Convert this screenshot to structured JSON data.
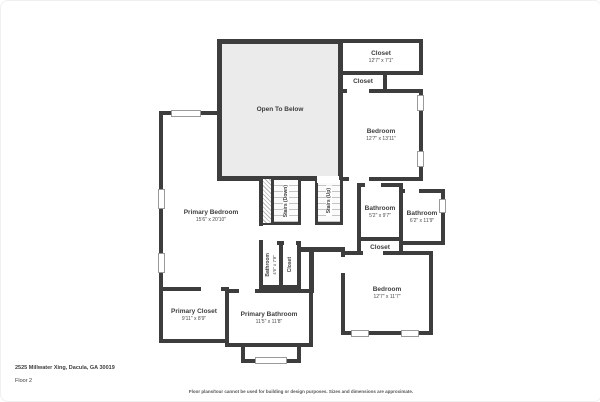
{
  "palette": {
    "wall": "#3d3d3d",
    "open_fill": "#ebebeb",
    "room_fill": "#ffffff",
    "window_border": "#9a9a9a"
  },
  "footer": {
    "address": "2525 Millwater Xing, Dacula, GA 30019",
    "floor": "Floor 2",
    "disclaimer": "Floor plans/tour cannot be used for building or design purposes. Sizes and dimensions are approximate."
  },
  "rooms": {
    "open_to_below": {
      "name": "Open To Below"
    },
    "closet_top": {
      "name": "Closet",
      "dims": "12'7\" x 7'1\""
    },
    "closet_top_small": {
      "name": "Closet"
    },
    "bedroom_top": {
      "name": "Bedroom",
      "dims": "12'7\" x 13'11\""
    },
    "primary_bedroom": {
      "name": "Primary Bedroom",
      "dims": "15'6\" x 20'10\""
    },
    "stairs_down": {
      "name": "Stairs (Down)"
    },
    "stairs_up": {
      "name": "Stairs (Up)"
    },
    "bathroom_hall_left": {
      "name": "Bathroom",
      "dims": "5'2\" x 9'7\""
    },
    "bathroom_hall_right": {
      "name": "Bathroom",
      "dims": "6'2\" x 11'9\""
    },
    "closet_mid": {
      "name": "Closet"
    },
    "bedroom_bottom": {
      "name": "Bedroom",
      "dims": "12'7\" x 11'7\""
    },
    "bathroom_small": {
      "name": "Bathroom",
      "dims": "4'6\" x 7'8\""
    },
    "closet_small": {
      "name": "Closet"
    },
    "primary_closet": {
      "name": "Primary Closet",
      "dims": "9'11\" x 8'9\""
    },
    "primary_bathroom": {
      "name": "Primary Bathroom",
      "dims": "11'5\" x 11'8\""
    }
  }
}
